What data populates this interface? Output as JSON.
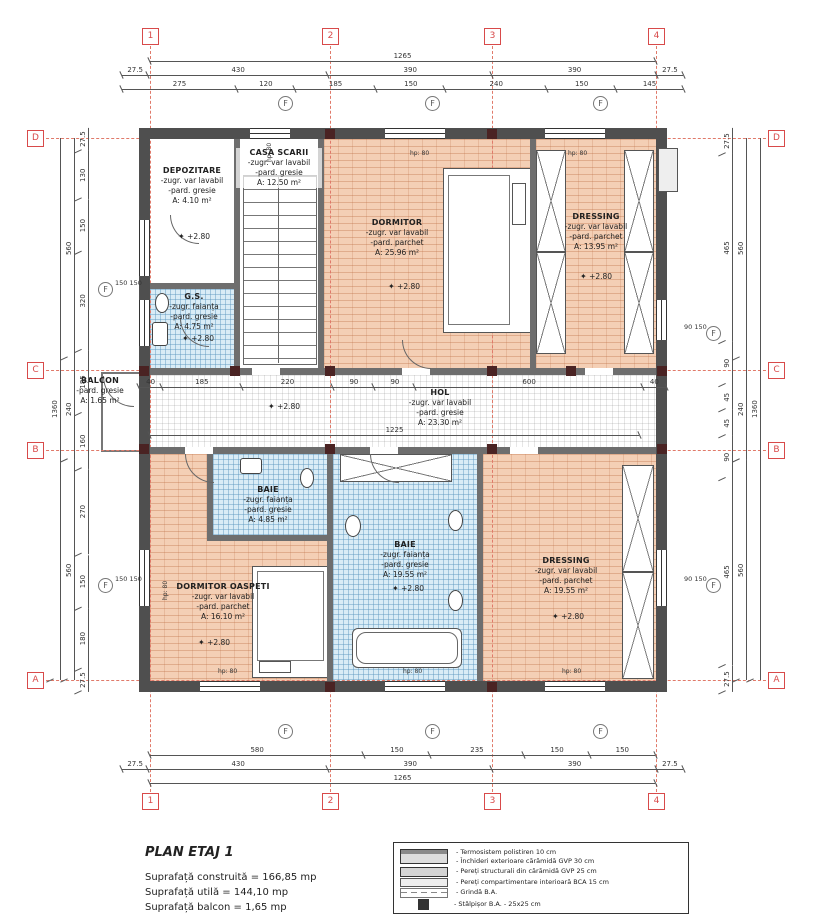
{
  "plan": {
    "title": "PLAN ETAJ 1",
    "areas": [
      "Suprafață construită = 166,85 mp",
      "Suprafață utilă = 144,10 mp",
      "Suprafață balcon = 1,65 mp"
    ]
  },
  "legend": {
    "rows": [
      {
        "lines": [
          "- Termosistem polistiren  10 cm",
          "- Închideri exterioare cărămidă GVP 30 cm"
        ]
      },
      {
        "lines": [
          "- Pereți structurali din cărămidă GVP 25 cm"
        ]
      },
      {
        "lines": [
          "- Pereți compartimentare interioară BCA 15 cm"
        ]
      },
      {
        "lines": [
          "- Grindă B.A."
        ]
      },
      {
        "lines": [
          "- Stâlpișor B.A. - 25x25 cm"
        ]
      }
    ]
  },
  "grid": {
    "cols": [
      "1",
      "2",
      "3",
      "4"
    ],
    "rows": [
      "D",
      "C",
      "B",
      "A"
    ],
    "f_axis": "F"
  },
  "dims": {
    "top": {
      "overall": [
        "1265"
      ],
      "row2": [
        "27.5",
        "430",
        "390",
        "390",
        "27.5"
      ],
      "row3": [
        "275",
        "120",
        "185",
        "150",
        "240",
        "150",
        "145"
      ]
    },
    "bottom": {
      "row1": [
        "580",
        "150",
        "235",
        "150",
        "150"
      ],
      "row2": [
        "27.5",
        "430",
        "390",
        "390",
        "27.5"
      ],
      "overall": [
        "1265"
      ]
    },
    "left": {
      "overall": [
        "1360"
      ],
      "mid": [
        "560",
        "240",
        "560"
      ],
      "inner": [
        "27.5",
        "130",
        "150",
        "320",
        "185",
        "160",
        "270",
        "150",
        "180",
        "27.5"
      ],
      "f_pair": "150 150"
    },
    "right": {
      "overall": [
        "1360"
      ],
      "mid": [
        "560",
        "240",
        "560"
      ],
      "inner": [
        "27.5",
        "465",
        "90",
        "45",
        "45",
        "90",
        "465",
        "27.5"
      ],
      "f_pair": "90 150"
    },
    "hall": {
      "chain": [
        "40",
        "185",
        "220",
        "90",
        "90",
        "600",
        "40"
      ],
      "overall": [
        "1225"
      ]
    }
  },
  "window_label": "hp: 80",
  "rooms": [
    {
      "name": "DEPOZITARE",
      "l1": "-zugr. var lavabil",
      "l2": "-pard. gresie",
      "area": "A: 4.10 m²",
      "level": "+2.80"
    },
    {
      "name": "CASA SCARII",
      "l1": "-zugr. var lavabil",
      "l2": "-pard. gresie",
      "area": "A: 12.50 m²",
      "level": ""
    },
    {
      "name": "DORMITOR",
      "l1": "-zugr. var lavabil",
      "l2": "-pard. parchet",
      "area": "A: 25.96 m²",
      "level": "+2.80"
    },
    {
      "name": "DRESSING",
      "l1": "-zugr. var lavabil",
      "l2": "-pard. parchet",
      "area": "A: 13.95 m²",
      "level": "+2.80"
    },
    {
      "name": "G.S.",
      "l1": "-zugr. faianța",
      "l2": "-pard. gresie",
      "area": "A: 4.75 m²",
      "level": "+2.80"
    },
    {
      "name": "BALCON",
      "l1": "-pard. gresie",
      "l2": "",
      "area": "A: 1.65 m²",
      "level": ""
    },
    {
      "name": "HOL",
      "l1": "-zugr. var lavabil",
      "l2": "-pard. gresie",
      "area": "A: 23.30 m²",
      "level": "+2.80"
    },
    {
      "name": "BAIE",
      "l1": "-zugr. faianța",
      "l2": "-pard. gresie",
      "area": "A: 4.85 m²",
      "level": ""
    },
    {
      "name": "BAIE",
      "l1": "-zugr. faianța",
      "l2": "-pard. gresie",
      "area": "A: 19.55 m²",
      "level": "+2.80"
    },
    {
      "name": "DORMITOR OASPETI",
      "l1": "-zugr. var lavabil",
      "l2": "-pard. parchet",
      "area": "A: 16.10 m²",
      "level": "+2.80"
    },
    {
      "name": "DRESSING",
      "l1": "-zugr. var lavabil",
      "l2": "-pard. parchet",
      "area": "A: 19.55 m²",
      "level": "+2.80"
    }
  ],
  "star": "✦"
}
